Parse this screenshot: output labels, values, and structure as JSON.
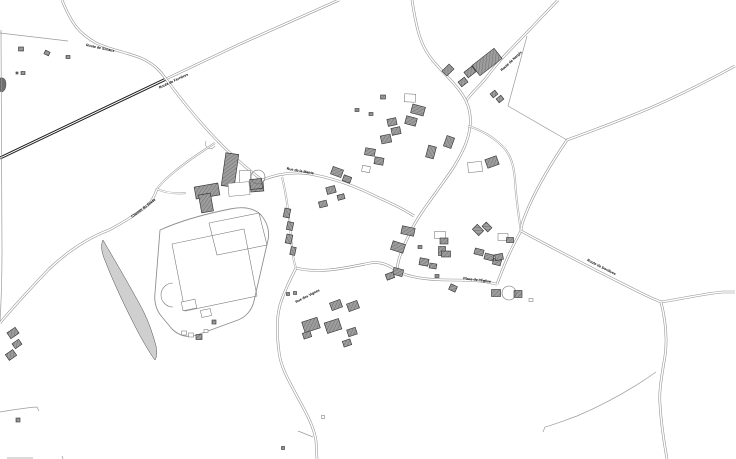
{
  "map": {
    "title": "cadastral-village-map",
    "colors": {
      "background": "#ffffff",
      "road_casing": "#8f8f8f",
      "road_core": "#ffffff",
      "main_road_casing": "#1e1e1e",
      "lane_casing": "#9a9a9a",
      "path_line": "#9b9b9b",
      "parcel_line": "#a8a8a8",
      "building_fill": "#9d9d9d",
      "building_hatch": "#6e6e6e",
      "building_stroke": "#2f2f2f",
      "outline_building_stroke": "#6a6a6a",
      "area_stroke": "#8f8f8f",
      "wedge_fill": "#cfcfcf",
      "label_color": "#000000"
    },
    "road_styles": {
      "main": {
        "casing": 3.0,
        "core": 1.0
      },
      "std": {
        "casing": 2.6,
        "core": 1.5
      },
      "lane": {
        "casing": 2.0,
        "core": 1.0
      },
      "path": {
        "casing": 0.7,
        "core": 0
      }
    },
    "labels": [
      {
        "text": "Route de Sceaux",
        "x": 100,
        "y": 49,
        "rot": 12,
        "size": 3.6
      },
      {
        "text": "Route de Ferrières",
        "x": 174,
        "y": 82,
        "rot": -25,
        "size": 3.6
      },
      {
        "text": "Route de Nargis",
        "x": 512,
        "y": 62,
        "rot": -43,
        "size": 3.6
      },
      {
        "text": "Chemin du Stade",
        "x": 144,
        "y": 209,
        "rot": -37,
        "size": 3.6
      },
      {
        "text": "Rue de la Mairie",
        "x": 300,
        "y": 172,
        "rot": 10,
        "size": 3.6
      },
      {
        "text": "Rue des Vignes",
        "x": 308,
        "y": 297,
        "rot": -27,
        "size": 3.6
      },
      {
        "text": "Place de l'Église",
        "x": 477,
        "y": 281,
        "rot": 7,
        "size": 3.6
      },
      {
        "text": "Route de Dordives",
        "x": 601,
        "y": 268,
        "rot": 27,
        "size": 3.6
      }
    ],
    "roads": [
      {
        "name": "main-diagonal-road",
        "type": "main",
        "d": "M0,158 L166,79"
      },
      {
        "name": "main-diagonal-ext",
        "type": "std",
        "d": "M166,79 L240,44 L339,0"
      },
      {
        "name": "north-west-route",
        "type": "std",
        "d": "M62,0 C72,25 80,34 96,43 C116,52 132,53 145,60 C156,66 160,71 166,79"
      },
      {
        "name": "north-east-diagonal",
        "type": "std",
        "d": "M558,0 L512,48 C500,60 492,70 486,78 C477,89 471,93 466,101"
      },
      {
        "name": "village-main-street",
        "type": "std",
        "d": "M412,0 C417,32 421,47 434,62 C448,78 460,88 466,101 C473,115 471,132 464,148 C456,166 446,178 437,191 C427,205 419,215 413,227 C407,239 402,249 399,259 C398,263 397,267 397,271"
      },
      {
        "name": "place-street",
        "type": "std",
        "d": "M296,268 C320,274 345,268 370,263 C382,261 390,266 397,271 C410,278 430,280 450,280 C462,280 475,280 487,282 C492,283 495,284 497,284"
      },
      {
        "name": "south-road",
        "type": "std",
        "d": "M296,268 C290,280 284,292 280,305 C276,320 277,336 279,352 C281,368 289,381 297,396 C305,411 314,426 316,441 L317,459"
      },
      {
        "name": "junction-to-village",
        "type": "std",
        "d": "M166,79 C180,98 197,119 214,137 C230,154 246,168 262,180"
      },
      {
        "name": "rue-mairie",
        "type": "std",
        "d": "M262,180 C280,173 298,171 315,175 C335,179 355,186 375,196 C390,203 402,208 414,216"
      },
      {
        "name": "west-lane",
        "type": "lane",
        "d": "M282,177 C287,197 289,217 291,237 C292,250 293,260 296,268"
      },
      {
        "name": "east-link-street",
        "type": "std",
        "d": "M497,284 C503,268 510,250 521,231"
      },
      {
        "name": "east-lane",
        "type": "lane",
        "d": "M468,126 C484,131 496,139 505,149 C512,158 514,168 515,180 C516,196 518,212 521,231"
      },
      {
        "name": "north-east-route",
        "type": "std",
        "d": "M735,66 C700,85 668,101 638,113 C613,123 589,132 567,140 C552,162 538,186 529,206 C524,218 521,225 521,231"
      },
      {
        "name": "east-route",
        "type": "std",
        "d": "M521,231 C560,252 601,273 641,293 C649,297 656,300 661,302"
      },
      {
        "name": "east-route-branch",
        "type": "std",
        "d": "M661,302 C681,299 703,294 722,292 L735,292"
      },
      {
        "name": "south-east-road",
        "type": "std",
        "d": "M661,302 C666,322 668,342 664,362 C661,380 659,392 660,404 C661,424 664,442 667,459"
      },
      {
        "name": "field-top-lane",
        "type": "lane",
        "d": "M215,143 C201,152 186,162 174,172 C167,178 161,183 157,189"
      },
      {
        "name": "stade-road",
        "type": "std",
        "d": "M0,323 C14,306 30,289 49,269 C68,251 88,238 109,230 C124,222 137,214 148,205 C152,201 155,195 157,189"
      },
      {
        "name": "church-lane",
        "type": "lane",
        "d": "M157,189 C166,193 176,194 186,193"
      },
      {
        "name": "south-east-path",
        "type": "path",
        "d": "M656,372 C632,389 603,405 577,416 C563,421 553,425 545,427 L543,432"
      },
      {
        "name": "bottom-left-path",
        "type": "path",
        "d": "M0,412 C12,410 24,408 37,407 L39,411"
      },
      {
        "name": "south-spur-path",
        "type": "path",
        "d": "M313,437 L298,431"
      },
      {
        "name": "left-edge-line",
        "type": "path",
        "d": "M1,30 L2,250 C2,285 1,305 0,322"
      },
      {
        "name": "parcel-top-left",
        "type": "path",
        "d": "M0,33 L68,41"
      },
      {
        "name": "parcel-funnel-1",
        "type": "path",
        "d": "M567,140 L508,106"
      },
      {
        "name": "parcel-funnel-2",
        "type": "path",
        "d": "M508,106 L527,36"
      },
      {
        "name": "bottom-edge-tick-1",
        "type": "path",
        "d": "M7,458 L33,458"
      },
      {
        "name": "bottom-edge-tick-2",
        "type": "path",
        "d": "M62,456 L63,459"
      }
    ],
    "areas": [
      {
        "name": "sports-field-outline",
        "d": "M160,230 C180,221 205,214 230,209 C244,206 254,208 261,215 C267,222 270,231 268,240 L254,301 C252,310 246,317 238,320 L197,335 C188,338 179,336 172,329 L162,317 C156,310 154,302 155,293 Z",
        "fill": "none",
        "stroke": "#8f8f8f",
        "sw": 0.9
      },
      {
        "name": "soccer-pitch",
        "d": "M172,244 L244,229 L257,296 L185,311 Z",
        "fill": "none",
        "stroke": "#7a7a7a",
        "sw": 0.6
      },
      {
        "name": "upper-pitch",
        "d": "M209,223 L259,213 L267,245 L217,255 Z",
        "fill": "none",
        "stroke": "#7a7a7a",
        "sw": 0.6
      },
      {
        "name": "pitch-arc",
        "d": "M173,283 A12,12 0 0 0 173,307",
        "fill": "none",
        "stroke": "#7a7a7a",
        "sw": 0.6
      },
      {
        "name": "road-bump-arc",
        "d": "M206,141 A4.5,4.5 0 0 0 215,146",
        "fill": "none",
        "stroke": "#9a9a9a",
        "sw": 0.6
      },
      {
        "name": "hedge-wedge",
        "d": "M103,240 C114,259 127,281 139,303 C147,317 152,331 156,346 C157,352 157,357 155,360 C151,355 145,345 138,332 C127,311 114,284 104,258 C101,250 101,244 103,240 Z",
        "fill": "#cfcfcf",
        "stroke": "#4a4a4a",
        "sw": 0.5
      },
      {
        "name": "left-edge-blob",
        "d": "M0,78 C4,77 6,80 6,84 C6,89 4,92 1,92 L0,91 Z",
        "fill": "#6f6f6f",
        "stroke": "#333333",
        "sw": 0.4
      }
    ],
    "circles": [
      {
        "name": "driveway-loop-east",
        "cx": 509,
        "cy": 293,
        "r": 7
      },
      {
        "name": "driveway-loop-church",
        "cx": 258,
        "cy": 177,
        "r": 7
      }
    ],
    "buildings": [
      {
        "x": 21,
        "y": 49,
        "w": 5,
        "h": 4,
        "r": 0,
        "t": "f"
      },
      {
        "x": 47,
        "y": 53,
        "w": 5,
        "h": 4,
        "r": 25,
        "t": "f"
      },
      {
        "x": 68,
        "y": 57,
        "w": 4,
        "h": 3,
        "r": 0,
        "t": "f"
      },
      {
        "x": 23,
        "y": 73,
        "w": 4,
        "h": 3,
        "r": 0,
        "t": "f"
      },
      {
        "x": 17,
        "y": 73,
        "w": 2,
        "h": 2,
        "r": 0,
        "t": "f"
      },
      {
        "x": 13,
        "y": 333,
        "w": 10,
        "h": 7,
        "r": -35,
        "t": "f"
      },
      {
        "x": 17,
        "y": 344,
        "w": 8,
        "h": 6,
        "r": -35,
        "t": "f"
      },
      {
        "x": 11,
        "y": 355,
        "w": 9,
        "h": 7,
        "r": -35,
        "t": "f"
      },
      {
        "x": 18,
        "y": 420,
        "w": 4,
        "h": 4,
        "r": 0,
        "t": "f"
      },
      {
        "x": 487,
        "y": 62,
        "w": 28,
        "h": 13,
        "r": -38,
        "t": "f"
      },
      {
        "x": 470,
        "y": 72,
        "w": 10,
        "h": 7,
        "r": -38,
        "t": "f"
      },
      {
        "x": 463,
        "y": 82,
        "w": 8,
        "h": 6,
        "r": -38,
        "t": "f"
      },
      {
        "x": 494,
        "y": 94,
        "w": 6,
        "h": 5,
        "r": -38,
        "t": "f"
      },
      {
        "x": 500,
        "y": 99,
        "w": 6,
        "h": 5,
        "r": -38,
        "t": "f"
      },
      {
        "x": 448,
        "y": 70,
        "w": 10,
        "h": 7,
        "r": -45,
        "t": "f"
      },
      {
        "x": 410,
        "y": 98,
        "w": 11,
        "h": 8,
        "r": 3,
        "t": "o"
      },
      {
        "x": 383,
        "y": 97,
        "w": 5,
        "h": 4,
        "r": 0,
        "t": "f"
      },
      {
        "x": 418,
        "y": 110,
        "w": 13,
        "h": 9,
        "r": 15,
        "t": "f"
      },
      {
        "x": 411,
        "y": 121,
        "w": 11,
        "h": 8,
        "r": 15,
        "t": "f"
      },
      {
        "x": 392,
        "y": 122,
        "w": 9,
        "h": 7,
        "r": -12,
        "t": "f"
      },
      {
        "x": 396,
        "y": 131,
        "w": 9,
        "h": 7,
        "r": -12,
        "t": "f"
      },
      {
        "x": 386,
        "y": 139,
        "w": 10,
        "h": 8,
        "r": -12,
        "t": "f"
      },
      {
        "x": 371,
        "y": 114,
        "w": 4,
        "h": 3,
        "r": 0,
        "t": "f"
      },
      {
        "x": 357,
        "y": 110,
        "w": 4,
        "h": 3,
        "r": 0,
        "t": "f"
      },
      {
        "x": 449,
        "y": 142,
        "w": 11,
        "h": 8,
        "r": -70,
        "t": "f"
      },
      {
        "x": 431,
        "y": 152,
        "w": 12,
        "h": 8,
        "r": -75,
        "t": "f"
      },
      {
        "x": 492,
        "y": 162,
        "w": 12,
        "h": 9,
        "r": -20,
        "t": "f"
      },
      {
        "x": 475,
        "y": 167,
        "w": 14,
        "h": 10,
        "r": -5,
        "t": "o"
      },
      {
        "x": 370,
        "y": 152,
        "w": 10,
        "h": 7,
        "r": 10,
        "t": "f"
      },
      {
        "x": 379,
        "y": 161,
        "w": 9,
        "h": 7,
        "r": 10,
        "t": "f"
      },
      {
        "x": 366,
        "y": 169,
        "w": 8,
        "h": 6,
        "r": 10,
        "t": "o"
      },
      {
        "x": 337,
        "y": 172,
        "w": 11,
        "h": 8,
        "r": 20,
        "t": "f"
      },
      {
        "x": 347,
        "y": 179,
        "w": 8,
        "h": 6,
        "r": 20,
        "t": "f"
      },
      {
        "x": 331,
        "y": 190,
        "w": 9,
        "h": 7,
        "r": -15,
        "t": "f"
      },
      {
        "x": 323,
        "y": 204,
        "w": 8,
        "h": 6,
        "r": -15,
        "t": "f"
      },
      {
        "x": 341,
        "y": 197,
        "w": 7,
        "h": 5,
        "r": -15,
        "t": "f"
      },
      {
        "x": 287,
        "y": 213,
        "w": 9,
        "h": 6,
        "r": -78,
        "t": "f"
      },
      {
        "x": 290,
        "y": 226,
        "w": 8,
        "h": 6,
        "r": -78,
        "t": "f"
      },
      {
        "x": 289,
        "y": 239,
        "w": 9,
        "h": 6,
        "r": -78,
        "t": "f"
      },
      {
        "x": 293,
        "y": 251,
        "w": 8,
        "h": 5,
        "r": -78,
        "t": "f"
      },
      {
        "x": 230,
        "y": 170,
        "w": 13,
        "h": 33,
        "r": 8,
        "t": "f"
      },
      {
        "x": 207,
        "y": 191,
        "w": 24,
        "h": 12,
        "r": -10,
        "t": "f"
      },
      {
        "x": 206,
        "y": 203,
        "w": 12,
        "h": 18,
        "r": -10,
        "t": "f"
      },
      {
        "x": 245,
        "y": 178,
        "w": 11,
        "h": 15,
        "r": 0,
        "t": "o"
      },
      {
        "x": 257,
        "y": 187,
        "w": 13,
        "h": 9,
        "r": -5,
        "t": "f"
      },
      {
        "x": 239,
        "y": 189,
        "w": 21,
        "h": 13,
        "r": -5,
        "t": "o"
      },
      {
        "x": 256,
        "y": 184,
        "w": 12,
        "h": 10,
        "r": -5,
        "t": "f"
      },
      {
        "x": 408,
        "y": 231,
        "w": 13,
        "h": 8,
        "r": 12,
        "t": "f"
      },
      {
        "x": 440,
        "y": 235,
        "w": 11,
        "h": 7,
        "r": 0,
        "t": "o"
      },
      {
        "x": 444,
        "y": 241,
        "w": 8,
        "h": 6,
        "r": 0,
        "t": "f"
      },
      {
        "x": 442,
        "y": 251,
        "w": 7,
        "h": 9,
        "r": 0,
        "t": "f"
      },
      {
        "x": 398,
        "y": 247,
        "w": 13,
        "h": 9,
        "r": 18,
        "t": "f"
      },
      {
        "x": 446,
        "y": 254,
        "w": 9,
        "h": 6,
        "r": 0,
        "t": "f"
      },
      {
        "x": 424,
        "y": 262,
        "w": 9,
        "h": 7,
        "r": 10,
        "t": "f"
      },
      {
        "x": 433,
        "y": 266,
        "w": 7,
        "h": 5,
        "r": 10,
        "t": "f"
      },
      {
        "x": 398,
        "y": 272,
        "w": 10,
        "h": 7,
        "r": 15,
        "t": "f"
      },
      {
        "x": 420,
        "y": 247,
        "w": 4,
        "h": 3,
        "r": 0,
        "t": "f"
      },
      {
        "x": 437,
        "y": 276,
        "w": 4,
        "h": 3,
        "r": 0,
        "t": "f"
      },
      {
        "x": 478,
        "y": 230,
        "w": 9,
        "h": 7,
        "r": 45,
        "t": "f"
      },
      {
        "x": 487,
        "y": 227,
        "w": 8,
        "h": 6,
        "r": 45,
        "t": "f"
      },
      {
        "x": 479,
        "y": 252,
        "w": 9,
        "h": 6,
        "r": 15,
        "t": "f"
      },
      {
        "x": 489,
        "y": 257,
        "w": 9,
        "h": 6,
        "r": 15,
        "t": "f"
      },
      {
        "x": 497,
        "y": 262,
        "w": 8,
        "h": 6,
        "r": 15,
        "t": "f"
      },
      {
        "x": 453,
        "y": 288,
        "w": 7,
        "h": 6,
        "r": 25,
        "t": "f"
      },
      {
        "x": 503,
        "y": 237,
        "w": 10,
        "h": 7,
        "r": 0,
        "t": "o"
      },
      {
        "x": 510,
        "y": 240,
        "w": 7,
        "h": 5,
        "r": 0,
        "t": "f"
      },
      {
        "x": 499,
        "y": 257,
        "w": 8,
        "h": 6,
        "r": -10,
        "t": "f"
      },
      {
        "x": 496,
        "y": 293,
        "w": 9,
        "h": 7,
        "r": 0,
        "t": "f"
      },
      {
        "x": 518,
        "y": 294,
        "w": 8,
        "h": 7,
        "r": 0,
        "t": "f"
      },
      {
        "x": 531,
        "y": 300,
        "w": 4,
        "h": 3,
        "r": 0,
        "t": "o"
      },
      {
        "x": 390,
        "y": 276,
        "w": 8,
        "h": 6,
        "r": -20,
        "t": "f"
      },
      {
        "x": 336,
        "y": 305,
        "w": 11,
        "h": 8,
        "r": -20,
        "t": "f"
      },
      {
        "x": 353,
        "y": 306,
        "w": 11,
        "h": 8,
        "r": -20,
        "t": "f"
      },
      {
        "x": 311,
        "y": 325,
        "w": 16,
        "h": 11,
        "r": -18,
        "t": "f"
      },
      {
        "x": 333,
        "y": 326,
        "w": 15,
        "h": 11,
        "r": -18,
        "t": "f"
      },
      {
        "x": 352,
        "y": 332,
        "w": 9,
        "h": 7,
        "r": -18,
        "t": "f"
      },
      {
        "x": 347,
        "y": 343,
        "w": 8,
        "h": 6,
        "r": -18,
        "t": "f"
      },
      {
        "x": 307,
        "y": 335,
        "w": 8,
        "h": 6,
        "r": -18,
        "t": "f"
      },
      {
        "x": 288,
        "y": 294,
        "w": 3,
        "h": 3,
        "r": 0,
        "t": "f"
      },
      {
        "x": 295,
        "y": 293,
        "w": 3,
        "h": 3,
        "r": 0,
        "t": "f"
      },
      {
        "x": 323,
        "y": 417,
        "w": 3,
        "h": 3,
        "r": 0,
        "t": "o"
      },
      {
        "x": 283,
        "y": 448,
        "w": 3,
        "h": 3,
        "r": 0,
        "t": "f"
      },
      {
        "x": 189,
        "y": 305,
        "w": 14,
        "h": 9,
        "r": -12,
        "t": "o"
      },
      {
        "x": 206,
        "y": 313,
        "w": 10,
        "h": 7,
        "r": -12,
        "t": "o"
      },
      {
        "x": 214,
        "y": 322,
        "w": 4,
        "h": 4,
        "r": 0,
        "t": "f"
      },
      {
        "x": 184,
        "y": 333,
        "w": 5,
        "h": 4,
        "r": 0,
        "t": "o"
      },
      {
        "x": 191,
        "y": 335,
        "w": 5,
        "h": 4,
        "r": 0,
        "t": "o"
      },
      {
        "x": 199,
        "y": 337,
        "w": 6,
        "h": 5,
        "r": 0,
        "t": "f"
      },
      {
        "x": 206,
        "y": 331,
        "w": 4,
        "h": 3,
        "r": 0,
        "t": "o"
      }
    ]
  }
}
